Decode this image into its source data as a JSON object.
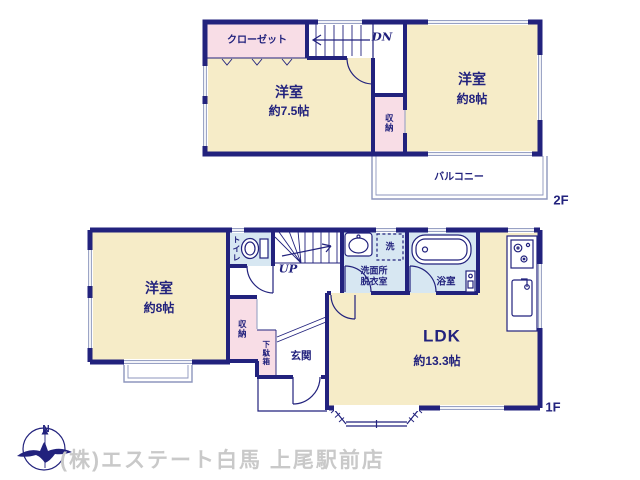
{
  "colors": {
    "wall": "#22227d",
    "navy": "#22227d",
    "cream": "#f6ecc8",
    "pink": "#f8dde6",
    "blue": "#d7e7f2",
    "wgray": "#98a1c4",
    "bgray": "#8d96bd",
    "cgray": "#c9c9c9"
  },
  "floor_2f": {
    "floor_label": "2F",
    "closet": "クローゼット",
    "stairs_down": "DN",
    "room_west_a_name": "洋室",
    "room_west_a_size": "約7.5帖",
    "storage": "収納",
    "room_west_b_name": "洋室",
    "room_west_b_size": "約8帖",
    "balcony": "バルコニー"
  },
  "floor_1f": {
    "floor_label": "1F",
    "room_west_name": "洋室",
    "room_west_size": "約8帖",
    "toilet": "トイレ",
    "stairs_up": "UP",
    "laundry": "洗",
    "washroom_line1": "洗面所",
    "washroom_line2": "脱衣室",
    "bathroom": "浴室",
    "storage": "収納",
    "shoe_cabinet": "下駄箱",
    "entrance": "玄関",
    "ldk_name": "LDK",
    "ldk_size": "約13.3帖"
  },
  "footer": {
    "compass_north": "N",
    "company": "(株)エステート白馬 上尾駅前店"
  }
}
